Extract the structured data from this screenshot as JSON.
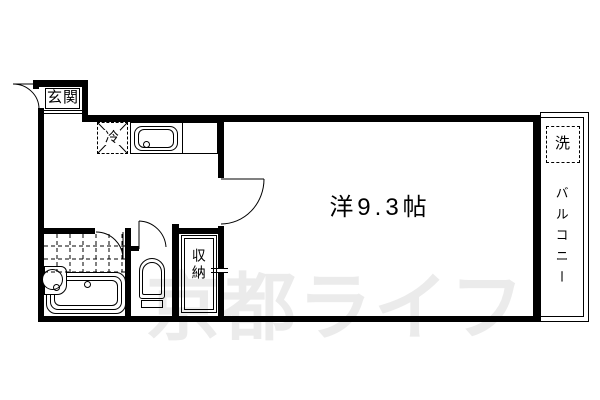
{
  "plan": {
    "title": "apartment-floor-plan",
    "labels": {
      "entrance": "玄関",
      "fridge": "冷",
      "main_room": "洋9.3帖",
      "storage": "収納",
      "washer": "洗",
      "balcony": "バルコニー"
    },
    "watermark": "京都ライフ",
    "colors": {
      "line": "#000000",
      "background": "#ffffff",
      "watermark": "#ebebeb"
    }
  }
}
